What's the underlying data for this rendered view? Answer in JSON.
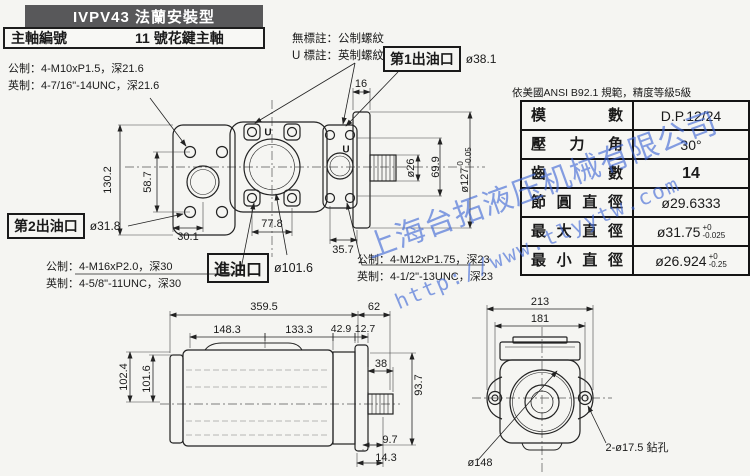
{
  "header": {
    "title": "IVPV43 法蘭安裝型",
    "shaft_no_label": "主軸編號",
    "shaft_no_value": "11 號花鍵主軸"
  },
  "thread_notes": {
    "no_mark": "無標註：公制螺紋",
    "u_mark": "U 標註：英制螺紋",
    "u_char": "U"
  },
  "ports": {
    "outlet1": {
      "label": "第1出油口",
      "dia": "ø38.1"
    },
    "outlet2": {
      "label": "第2出油口",
      "dia": "ø31.8"
    },
    "inlet": {
      "label": "進油口",
      "dia": "ø101.6"
    }
  },
  "thread_specs": {
    "top": {
      "metric": "公制：4-M10xP1.5，深21.6",
      "imperial": "英制：4-7/16\"-14UNC，深21.6"
    },
    "inlet": {
      "metric": "公制：4-M16xP2.0，深30",
      "imperial": "英制：4-5/8\"-11UNC，深30"
    },
    "outlet": {
      "metric": "公制：4-M12xP1.75，深23",
      "imperial": "英制：4-1/2\"-13UNC，深23"
    }
  },
  "spline_table": {
    "note": "依美國ANSI  B92.1 規範，精度等級5級",
    "rows": [
      {
        "name": "模數",
        "value": "D.P.12/24"
      },
      {
        "name": "壓力角",
        "value": "30°"
      },
      {
        "name": "齒數",
        "value": "14"
      },
      {
        "name": "節圓直徑",
        "value": "ø29.6333"
      },
      {
        "name": "最大直徑",
        "value": "ø31.75",
        "tol_top": "+0",
        "tol_bot": "-0.025"
      },
      {
        "name": "最小直徑",
        "value": "ø26.924",
        "tol_top": "+0",
        "tol_bot": "-0.25"
      }
    ]
  },
  "front_view": {
    "dims": {
      "overall_height": "130.2",
      "bolt_span": "58.7",
      "left_span": "30.1",
      "center_span": "77.8",
      "right_span": "35.7",
      "flange_thk": "16",
      "shaft_dia": "ø26",
      "pilot_dia": "69.9",
      "spigot_dia": "ø127",
      "spigot_tol_top": "0",
      "spigot_tol_bot": "-0.05"
    }
  },
  "side_view": {
    "dims": {
      "overall_len": "359.5",
      "rear_len": "62",
      "seg1": "148.3",
      "seg2": "133.3",
      "seg3": "42.9",
      "seg4": "12.7",
      "h_outer": "102.4",
      "h_inner": "101.6",
      "shaft_len": "38",
      "h_right": "93.7",
      "off1": "9.7",
      "off2": "14.3"
    }
  },
  "rear_view": {
    "dims": {
      "width": "213",
      "bolt_span": "181",
      "pilot": "ø148",
      "drill": "2-ø17.5 鉆孔"
    }
  },
  "watermark": {
    "line1": "上海台拓液压机械有限公司",
    "line2": "http://www.tlyytw.com",
    "color": "#3d66d6"
  }
}
